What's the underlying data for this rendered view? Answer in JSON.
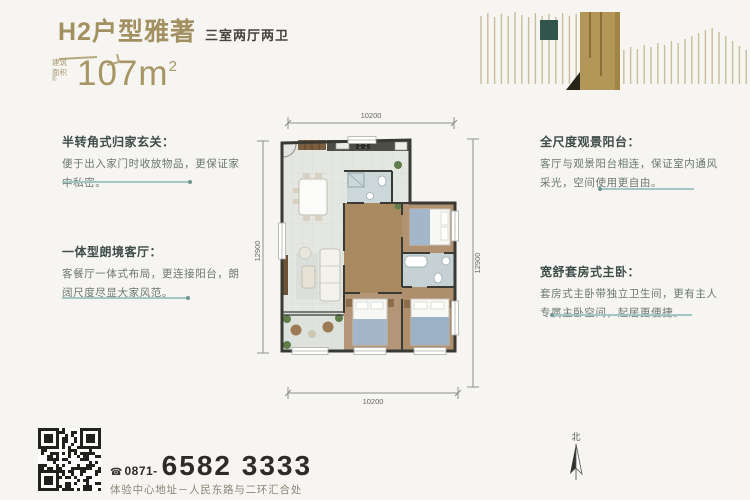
{
  "header": {
    "title": "H2户型雅著",
    "subtitle": "三室两厅两卫",
    "area_label": "建筑面积",
    "area_reg": "®",
    "area_value": "107m",
    "area_sup": "2"
  },
  "annotations": {
    "left": [
      {
        "title": "半转角式归家玄关：",
        "body": "便于出入家门时收放物品，更保证家中私密。"
      },
      {
        "title": "一体型朗境客厅：",
        "body": "客餐厅一体式布局，更连接阳台，朗阔尺度尽显大家风范。"
      }
    ],
    "right": [
      {
        "title": "全尺度观景阳台：",
        "body": "客厅与观景阳台相连，保证室内通风采光，空间使用更自由。"
      },
      {
        "title": "宽舒套房式主卧：",
        "body": "套房式主卧带独立卫生间，更有主人专属主卧空间，起居更便捷。"
      }
    ]
  },
  "floorplan": {
    "dim_top": "10200",
    "dim_bottom": "10200",
    "dim_left": "12900",
    "dim_right": "12900",
    "compass_label": "北"
  },
  "footer": {
    "phone_icon": "☎",
    "phone_prefix": "0871-",
    "phone_number": "6582 3333",
    "address": "体验中心地址－人民东路与二环汇合处"
  },
  "colors": {
    "accent_tan": "#a89564",
    "accent_teal": "#31544b",
    "line_teal": "#a5c6c6",
    "wall": "#3a3a35",
    "text_dark": "#3e4c4a",
    "text_body": "#6b7672"
  }
}
